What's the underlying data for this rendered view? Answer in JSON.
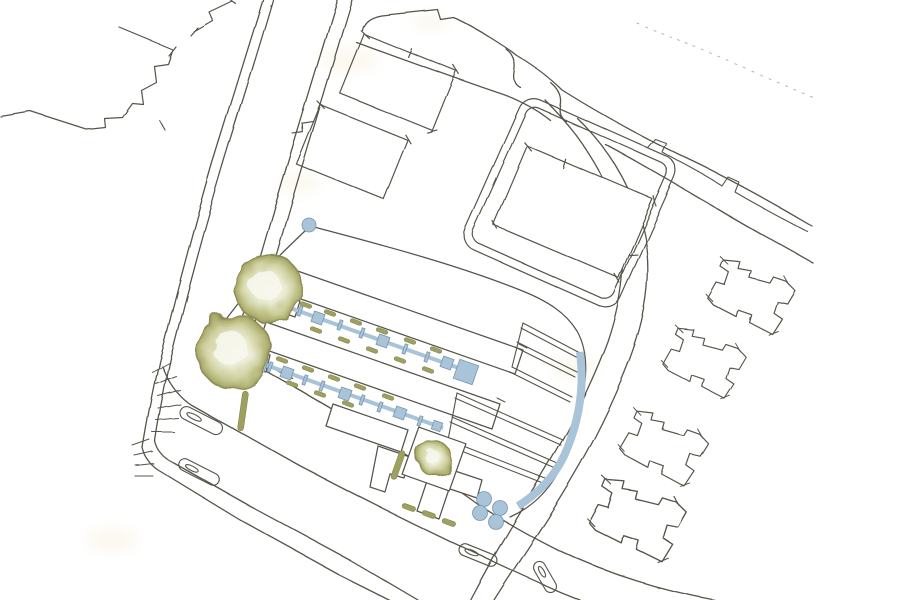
{
  "document": {
    "title": "Hand-drawn architectural site plan sketch",
    "type": "site plan",
    "style": "freehand ink linework with watercolor washes",
    "text_labels": "none visible"
  },
  "colors": {
    "paper": "#ffffff",
    "ink": "#55544a",
    "ink_light": "#8a897d",
    "tree_center": "#f8f8ef",
    "tree_light": "#e9ead0",
    "tree_mid": "#cfd1a0",
    "tree_dark": "#b0b172",
    "tree_edge": "#9a9b60",
    "tree_stroke": "#8b8c55",
    "planting": "#9da05f",
    "planting_stroke": "#7c7f45",
    "water_blue": "#a9c3d8",
    "water_blue_stroke": "#7696ae",
    "wash_yellow": "#f4ecd2",
    "building_fill": "#ffffff"
  },
  "features": {
    "large_site_trees": 2,
    "courtyard_tree": 1,
    "blue_entry_dot": 1,
    "blue_path_rows": 2,
    "blue_circle_trees": 4,
    "garden_plot_dividers": 6,
    "neighbor_houses_east": 4,
    "top_buildings": 3,
    "walled_plot_northeast": 1,
    "terrace_outlines_northwest": 2,
    "traffic_islands": 4,
    "junction_kerb_fans": 2,
    "roads": [
      "left avenue (double footways)",
      "top diagonal road",
      "right curving road",
      "two lower access roads"
    ]
  }
}
